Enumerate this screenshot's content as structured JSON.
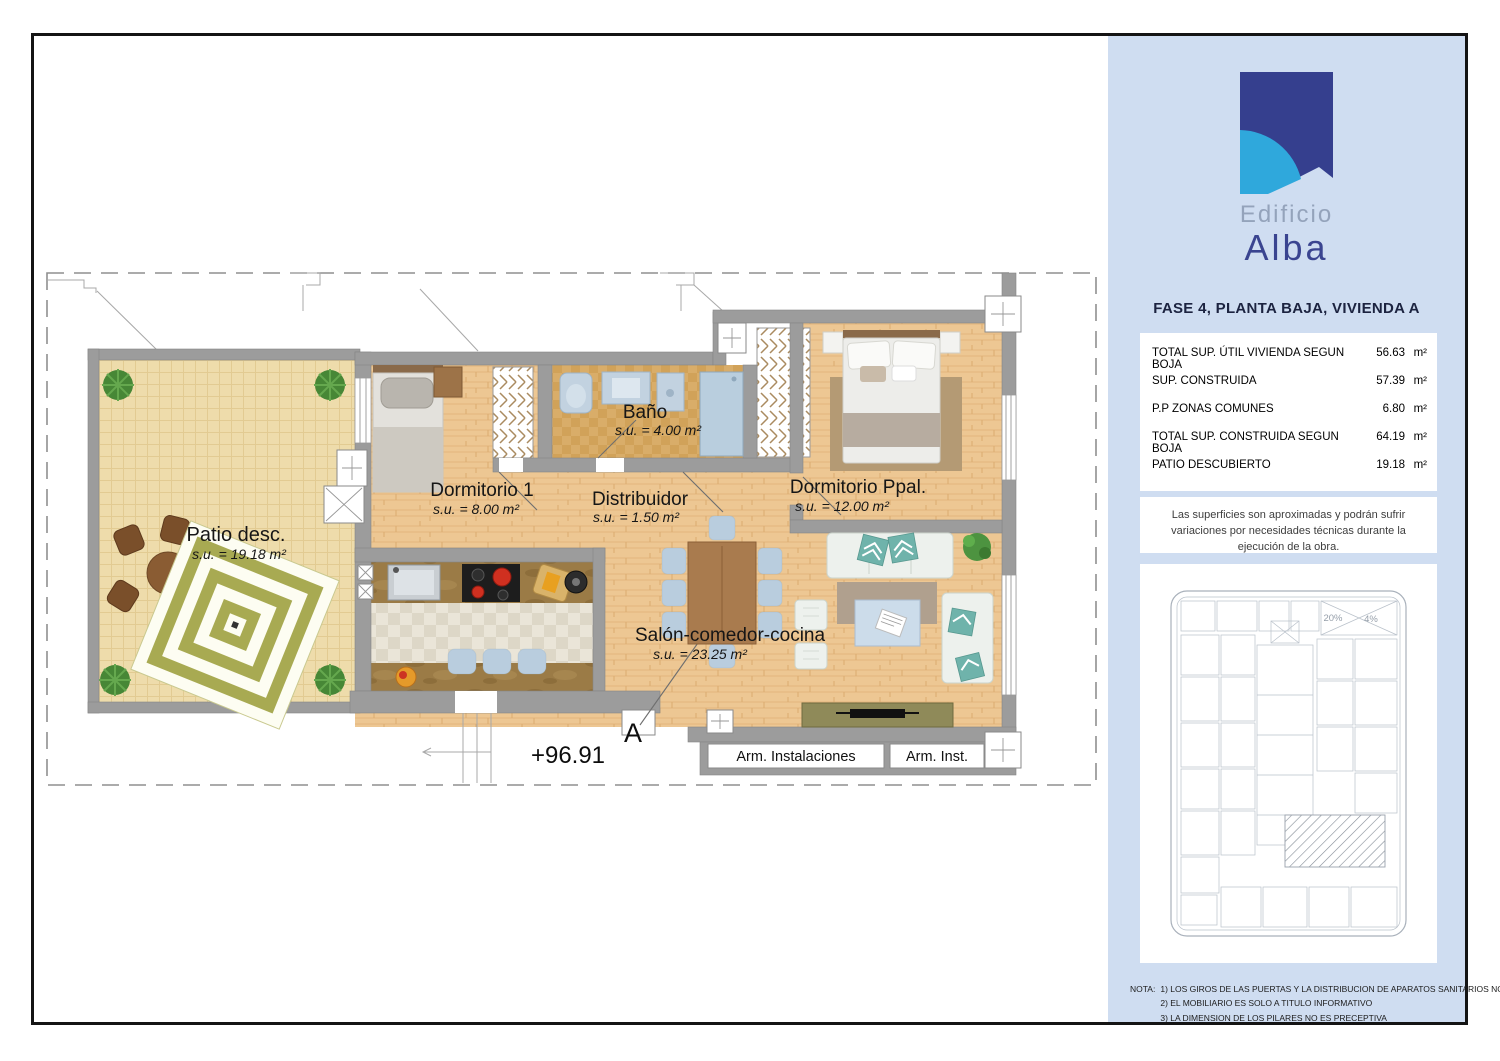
{
  "plan": {
    "rooms": {
      "patio": {
        "name": "Patio desc.",
        "area": "s.u. = 19.18 m²"
      },
      "dormitorio1": {
        "name": "Dormitorio 1",
        "area": "s.u. = 8.00 m²"
      },
      "bano": {
        "name": "Baño",
        "area": "s.u. = 4.00 m²"
      },
      "distribuidor": {
        "name": "Distribuidor",
        "area": "s.u. = 1.50 m²"
      },
      "dormitorio_ppal": {
        "name": "Dormitorio Ppal.",
        "area": "s.u. = 12.00 m²"
      },
      "salon": {
        "name": "Salón-comedor-cocina",
        "area": "s.u. = 23.25 m²"
      }
    },
    "closets": {
      "arm_instalaciones": "Arm. Instalaciones",
      "arm_inst": "Arm. Inst."
    },
    "level_mark": "+96.91",
    "section_mark": "A"
  },
  "sidebar": {
    "logo": {
      "line1": "Edificio",
      "line2": "Alba"
    },
    "title": "FASE 4, PLANTA BAJA, VIVIENDA A",
    "surface_table": {
      "rows": [
        {
          "label": "TOTAL SUP. ÚTIL VIVIENDA SEGUN BOJA",
          "value": "56.63",
          "unit": "m²"
        },
        {
          "label": "SUP. CONSTRUIDA",
          "value": "57.39",
          "unit": "m²"
        },
        {
          "label": "P.P ZONAS COMUNES",
          "value": "6.80",
          "unit": "m²"
        },
        {
          "label": "TOTAL SUP. CONSTRUIDA SEGUN BOJA",
          "value": "64.19",
          "unit": "m²"
        },
        {
          "label": "PATIO DESCUBIERTO",
          "value": "19.18",
          "unit": "m²"
        }
      ]
    },
    "disclaimer": "Las superficies son aproximadas y podrán sufrir variaciones por necesidades técnicas durante la ejecución de la obra.",
    "siteplan": {
      "label_20": "20%",
      "label_4": "4%"
    },
    "notes": {
      "label": "NOTA:",
      "items": [
        "1)  LOS GIROS DE LAS PUERTAS Y LA DISTRIBUCION DE APARATOS SANITARIOS NO ES VINCULANTE",
        "2)  EL MOBILIARIO ES SOLO A TITULO INFORMATIVO",
        "3)  LA DIMENSION DE LOS PILARES NO ES PRECEPTIVA"
      ]
    }
  },
  "colors": {
    "sidebar_bg": "#cfddf1",
    "logo_navy": "#353f8e",
    "logo_sky": "#2fa8dc",
    "wall_gray": "#9c9c9c",
    "wood_floor": "#edc793",
    "patio_floor": "#eedcab",
    "bath_tile": "#d9ad69",
    "accent_teal": "#6fb3ab"
  }
}
